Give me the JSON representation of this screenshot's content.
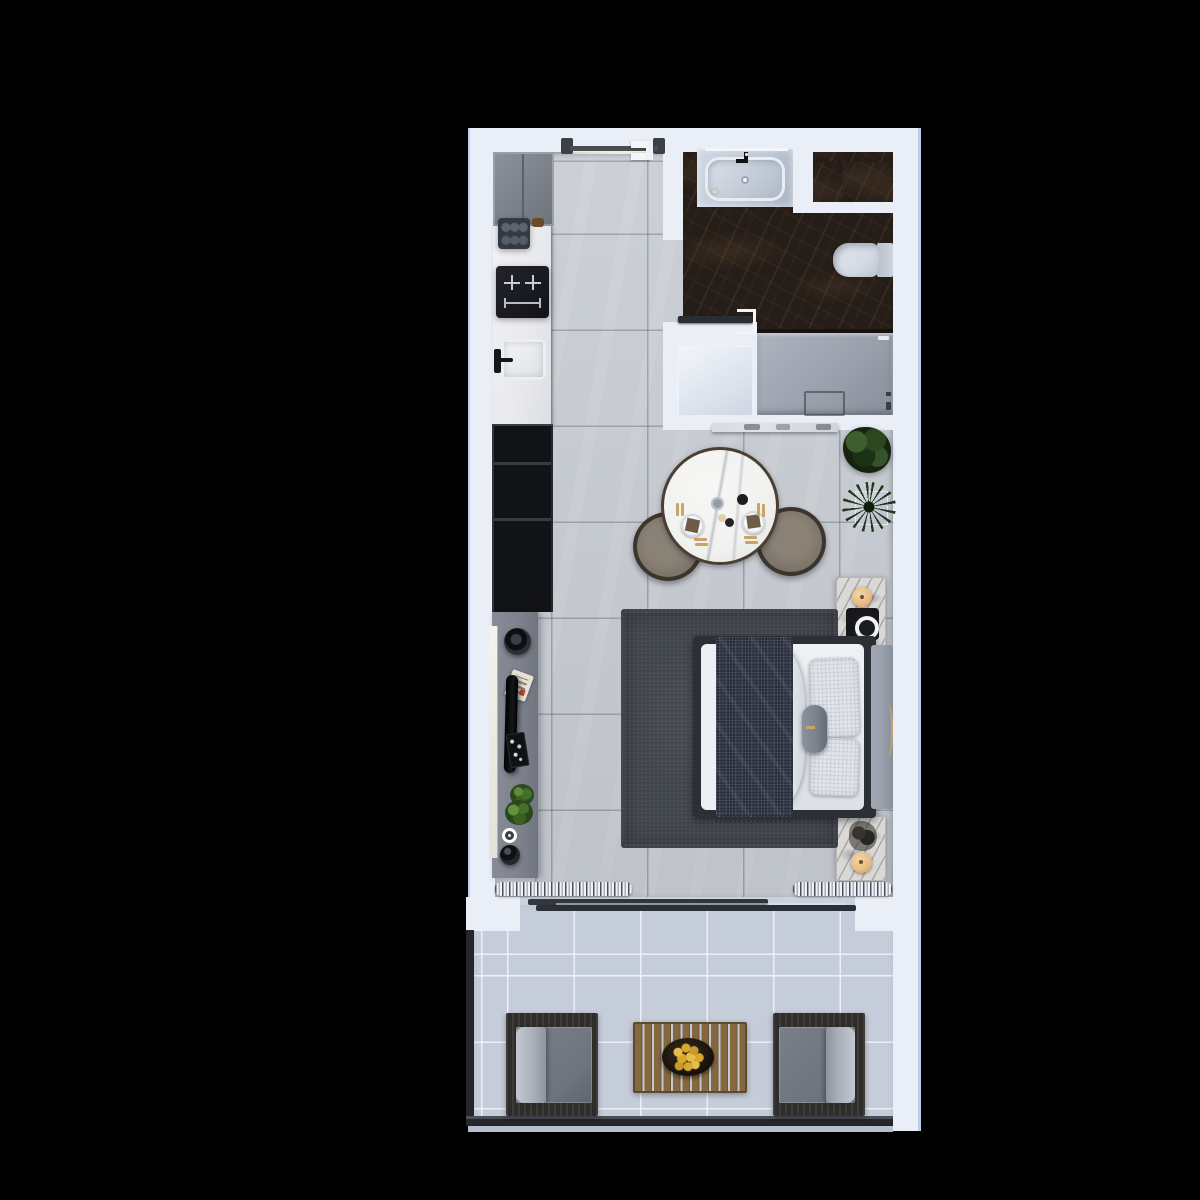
{
  "meta": {
    "title": "Studio apartment floor plan — top-down 3D render",
    "type": "floor-plan"
  },
  "palette": {
    "bg": "#000000",
    "wall": "#e9eef7",
    "walledge": "#b9cce9",
    "floor": "#c9cdd4",
    "marbledark": "#251d18",
    "shower": "#9aa1ad",
    "utility": "#e7ecf4",
    "counter": "#e8e9ec",
    "cabinet": "#7e838b",
    "black": "#17181c",
    "console": "#7d828c",
    "ledge": "#ece9e3",
    "tablewhite": "#f1f1ef",
    "tablerim": "#4b3e33",
    "chairfabric": "#7c7468",
    "chairframe": "#3b352d",
    "plantdark": "#16230f",
    "plantmid": "#3c5a2b",
    "bench": "#dfe2e8",
    "rug": "#43474f",
    "bedframe": "#2c2f36",
    "mattress": "#e9ebee",
    "throw": "#272c38",
    "pillow": "#e2e5eb",
    "bolster": "#7d838e",
    "headboard": "#99a0ab",
    "gold": "#c9a465",
    "nsmarble": "#dbd9d6",
    "lamp": "#e6ba83",
    "curtainlight": "#eef1f6",
    "curtaindark": "#4a4f58",
    "track": "#32363d",
    "entryfloor": "#e9e1d2",
    "doorpost": "#3c4047",
    "balconyfloor": "#c6cdda",
    "railing": "#23262c",
    "chairwood": "#2f2d29",
    "cushion": "#6e747e",
    "cushionlight": "#a8aeb8",
    "wood": "#86683f",
    "bowl": "#151109",
    "fruit": "#d9a72f",
    "toilet": "#d5dbe3",
    "basin": "#c7cfdb",
    "vanity": "#bfc8d5"
  },
  "rooms": [
    {
      "id": "kitchen",
      "label": "Kitchenette"
    },
    {
      "id": "entry-hall",
      "label": "Entry hall"
    },
    {
      "id": "bathroom",
      "label": "Bathroom"
    },
    {
      "id": "shower",
      "label": "Walk-in shower"
    },
    {
      "id": "utility-nook",
      "label": "Utility nook"
    },
    {
      "id": "living-bedroom",
      "label": "Living / bedroom"
    },
    {
      "id": "balcony",
      "label": "Balcony"
    }
  ],
  "furniture": {
    "entry_door": "Entry sliding door",
    "bathroom_door": "Bathroom door",
    "fridge": "Kitchen tall cabinet",
    "coffee_machine": "Coffee machine",
    "cooktop": "Induction cooktop",
    "sink": "Kitchen sink",
    "shelf": "Open shelving unit",
    "tv_console": "TV media console",
    "tv": "Television",
    "washbasin": "Vanity basin",
    "toilet": "Toilet",
    "shower_drain": "Shower drain",
    "bench": "Marble bench",
    "dining_table": "Round dining table for two",
    "dining_chair": "Dining chair",
    "plant_leafy": "Potted plant",
    "plant_spiky": "Spiky potted plant",
    "bed": "Double bed",
    "rug": "Area rug",
    "nightstand": "Nightstand",
    "lamp": "Table lamp",
    "speaker": "Speaker / charger",
    "curtain": "Curtain",
    "balcony_door": "Sliding glass door",
    "armchair": "Outdoor armchair",
    "coffee_table": "Slatted coffee table",
    "fruit_bowl": "Fruit bowl"
  }
}
